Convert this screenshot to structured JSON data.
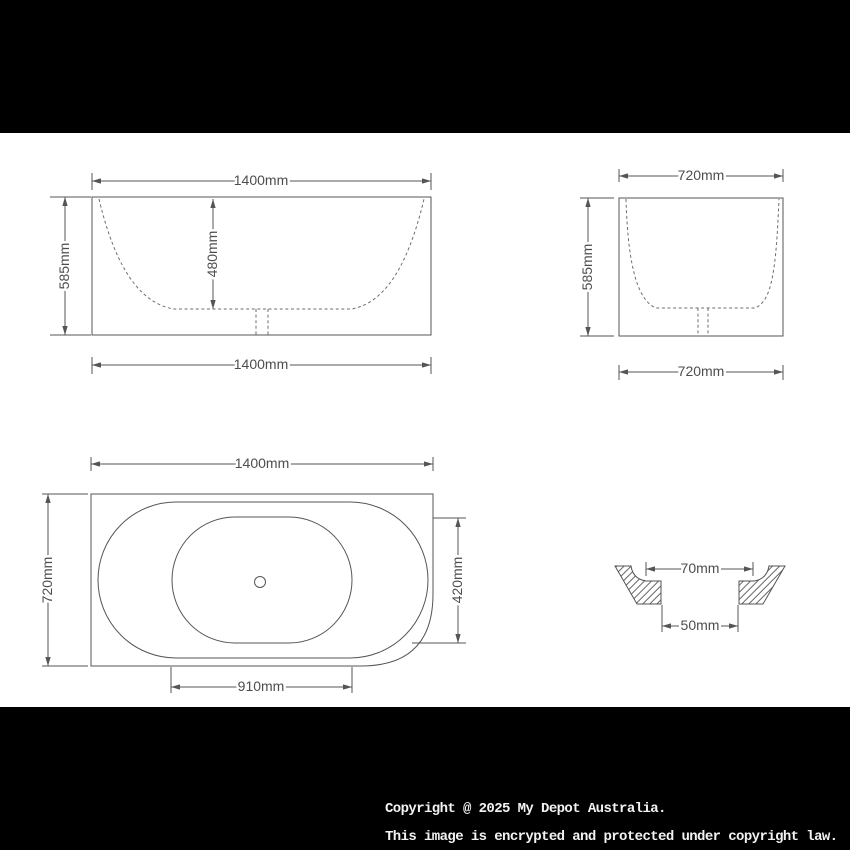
{
  "product": "bathtub-dimension-drawing",
  "colors": {
    "background": "#000000",
    "sheet": "#ffffff",
    "line": "#555555",
    "label_text": "#4d4d4d",
    "copyright_text": "#f2f2f2"
  },
  "views": {
    "front": {
      "name": "front elevation",
      "top": "1400mm",
      "left": "585mm",
      "inner_depth": "480mm",
      "bottom": "1400mm"
    },
    "side": {
      "name": "side elevation",
      "top": "720mm",
      "left": "585mm",
      "bottom": "720mm"
    },
    "plan": {
      "name": "top plan view",
      "top": "1400mm",
      "left": "720mm",
      "right": "420mm",
      "bottom": "910mm"
    },
    "drain_detail": {
      "name": "waste hole section",
      "top": "70mm",
      "bottom": "50mm"
    }
  },
  "copyright": {
    "line1": "Copyright @ 2025 My Depot Australia.",
    "line2": "This image is encrypted and protected under copyright law."
  }
}
